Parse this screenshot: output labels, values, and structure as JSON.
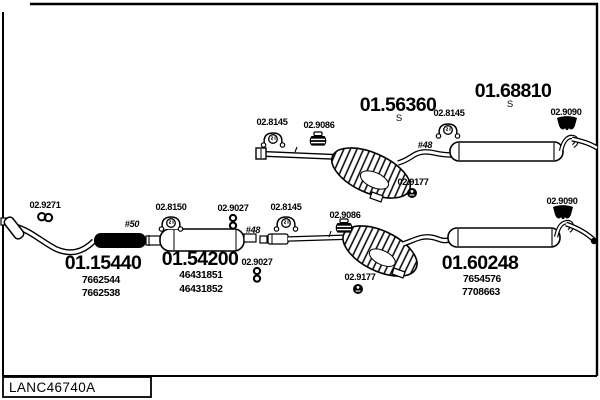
{
  "page": {
    "footer_code": "LANC46740A"
  },
  "assemblies": [
    {
      "code": "01.56360",
      "variant": "S"
    },
    {
      "code": "01.68810",
      "variant": "S"
    },
    {
      "code": "01.15440",
      "oem": [
        "7662544",
        "7662538"
      ]
    },
    {
      "code": "01.54200",
      "oem": [
        "46431851",
        "46431852"
      ]
    },
    {
      "code": "01.60248",
      "oem": [
        "7654576",
        "7708663"
      ]
    }
  ],
  "fittings": [
    {
      "code": "02.8145"
    },
    {
      "code": "02.9086"
    },
    {
      "code": "02.8145"
    },
    {
      "code": "02.9090"
    },
    {
      "code": "02.9177"
    },
    {
      "code": "02.9271"
    },
    {
      "code": "02.8150"
    },
    {
      "code": "02.9027"
    },
    {
      "code": "02.8145"
    },
    {
      "code": "02.9086"
    },
    {
      "code": "02.9027"
    },
    {
      "code": "02.9177"
    },
    {
      "code": "02.9090"
    }
  ],
  "dimensions": [
    {
      "text": "#48"
    },
    {
      "text": "#50"
    },
    {
      "text": "#48"
    }
  ],
  "colors": {
    "ink": "#000000",
    "paper": "#ffffff"
  }
}
